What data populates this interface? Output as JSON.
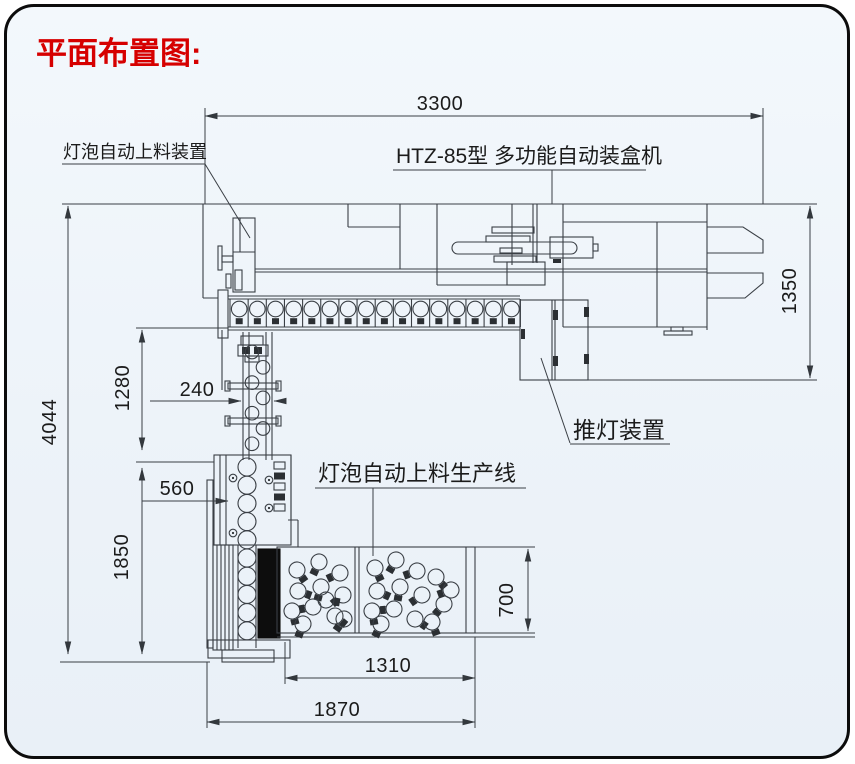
{
  "title": "平面布置图:",
  "labels": {
    "feeder_device": "灯泡自动上料装置",
    "cartoning_machine": "HTZ-85型 多功能自动装盒机",
    "lamp_pusher": "推灯装置",
    "feeding_line": "灯泡自动上料生产线"
  },
  "dimensions": {
    "overall_width": "3300",
    "machine_depth": "1350",
    "overall_depth": "4044",
    "conveyor_section": "1280",
    "conveyor_width": "240",
    "feeder_offset": "560",
    "lower_section": "1850",
    "tray_depth": "700",
    "tray_width": "1310",
    "base_width": "1870"
  },
  "colors": {
    "title_red": "#d60000",
    "line_color": "#3a3f45",
    "canvas_fill": "#eff4fa",
    "border_black": "#0c0c0c"
  }
}
